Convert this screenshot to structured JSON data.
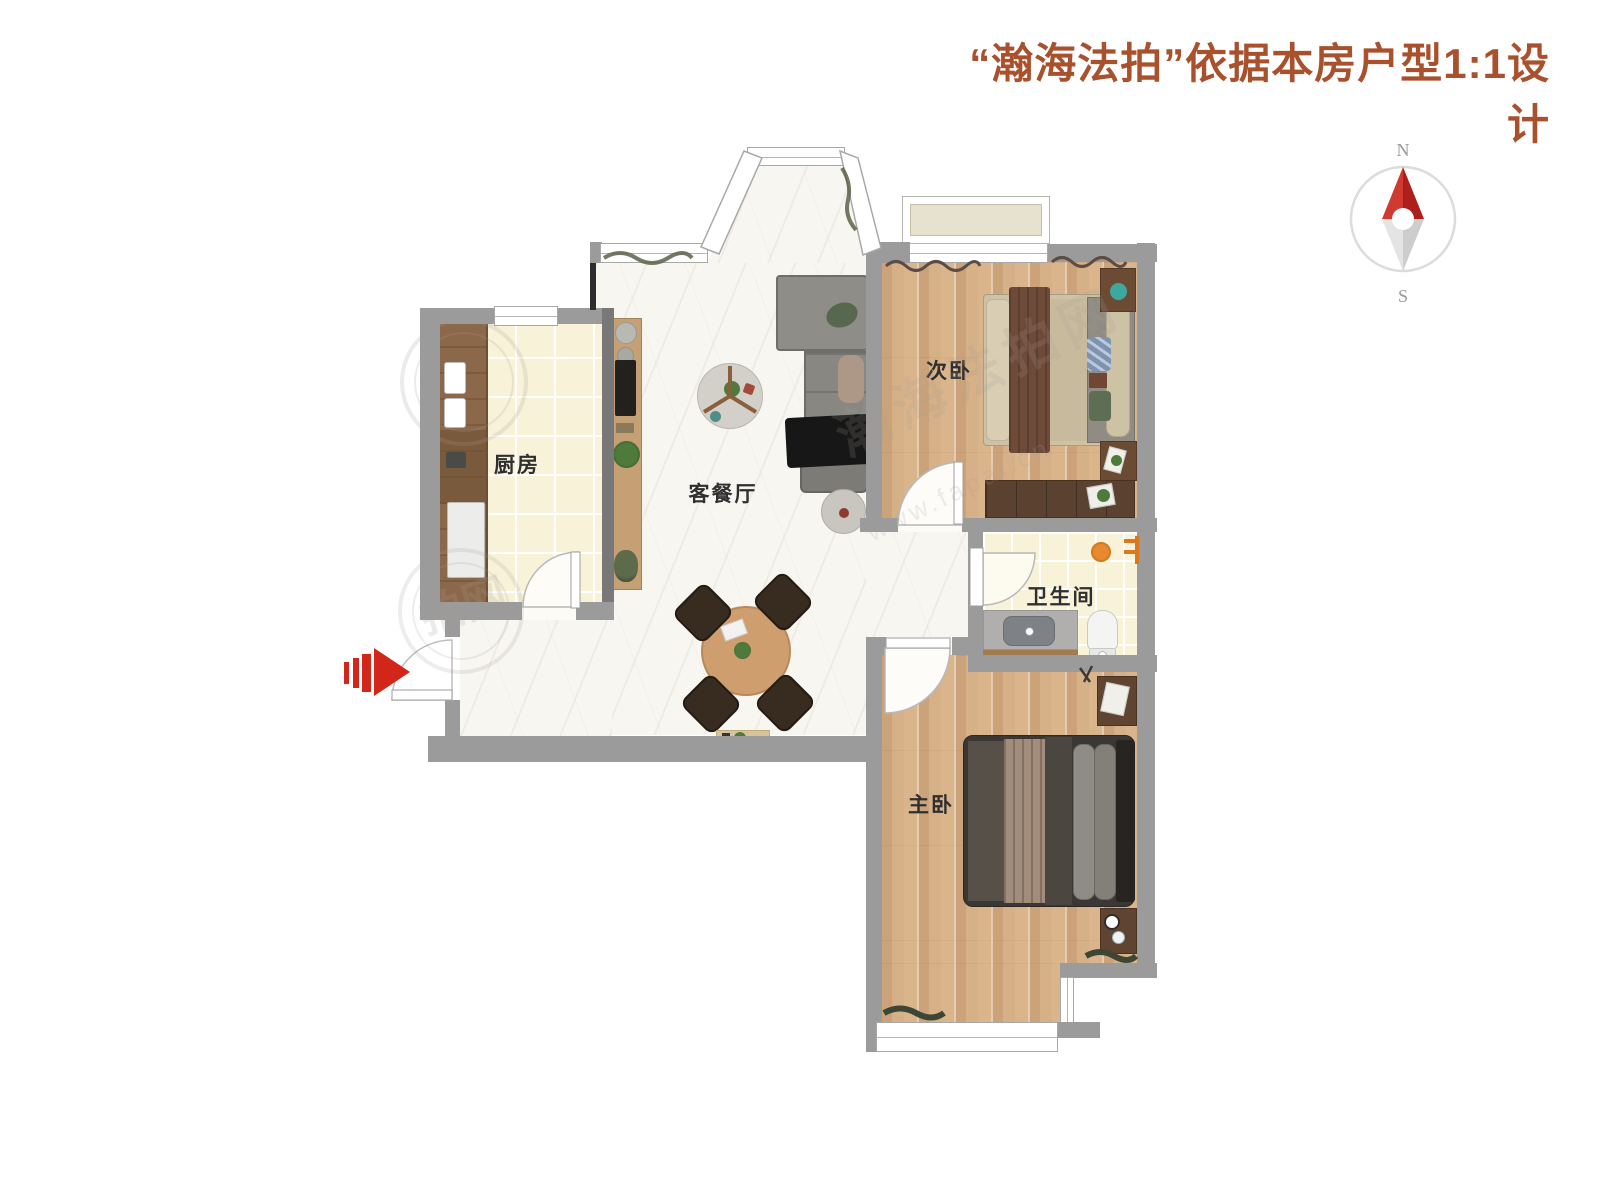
{
  "title": {
    "text": "“瀚海法拍”依据本房户型1:1设计",
    "color": "#a8512c"
  },
  "compass": {
    "north": "N",
    "south": "S",
    "needle_color": "#c9302a"
  },
  "rooms": {
    "kitchen": {
      "label": "厨房"
    },
    "living_dining": {
      "label": "客餐厅"
    },
    "secondary_bedroom": {
      "label": "次卧"
    },
    "bathroom": {
      "label": "卫生间"
    },
    "master_bedroom": {
      "label": "主卧"
    }
  },
  "entrance": {
    "arrow_color": "#d2261b"
  },
  "watermarks": {
    "brand": "瀚海法拍网",
    "url": "www.fapai.cn",
    "partial": "拍网"
  },
  "colors": {
    "wall": "#9b9b9b",
    "wood_floor": "#d8b38c",
    "tile_floor": "#f8f2d9",
    "marble_floor": "#f8f6f1",
    "counter_wood": "#8b6849",
    "sofa_gray": "#8e8d88"
  }
}
